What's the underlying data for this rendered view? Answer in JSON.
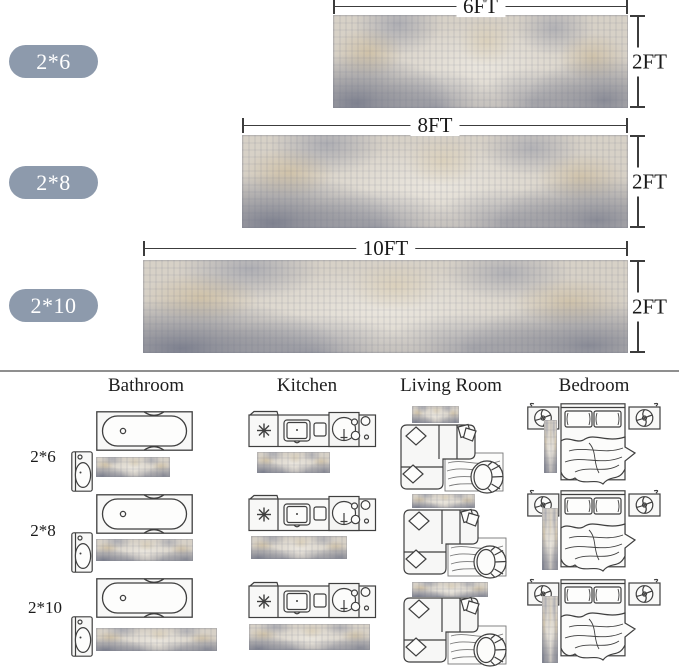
{
  "sizes": [
    {
      "label": "2*6",
      "width_label": "6FT",
      "height_label": "2FT"
    },
    {
      "label": "2*8",
      "width_label": "8FT",
      "height_label": "2FT"
    },
    {
      "label": "2*10",
      "width_label": "10FT",
      "height_label": "2FT"
    }
  ],
  "room_headers": [
    "Bathroom",
    "Kitchen",
    "Living Room",
    "Bedroom"
  ],
  "placement_rows": [
    {
      "label": "2*6"
    },
    {
      "label": "2*8"
    },
    {
      "label": "2*10"
    }
  ],
  "icons": [
    "bathtub-icon",
    "toilet-icon",
    "kitchen-counter-icon",
    "sofa-icon",
    "bed-with-nightstands-icon"
  ],
  "colors": {
    "size_pill_bg": "#8d9aac",
    "size_pill_text": "#ffffff",
    "dimension_line": "#3c3c3c",
    "divider": "#8f8f8f",
    "drawing_stroke": "#3f3f3f",
    "rug_base": "#d7d1c7",
    "rug_slate": "#8a90a2",
    "rug_tan": "#c9b58f",
    "rug_dark": "#6e7386",
    "rug_light": "#e9e6df"
  }
}
